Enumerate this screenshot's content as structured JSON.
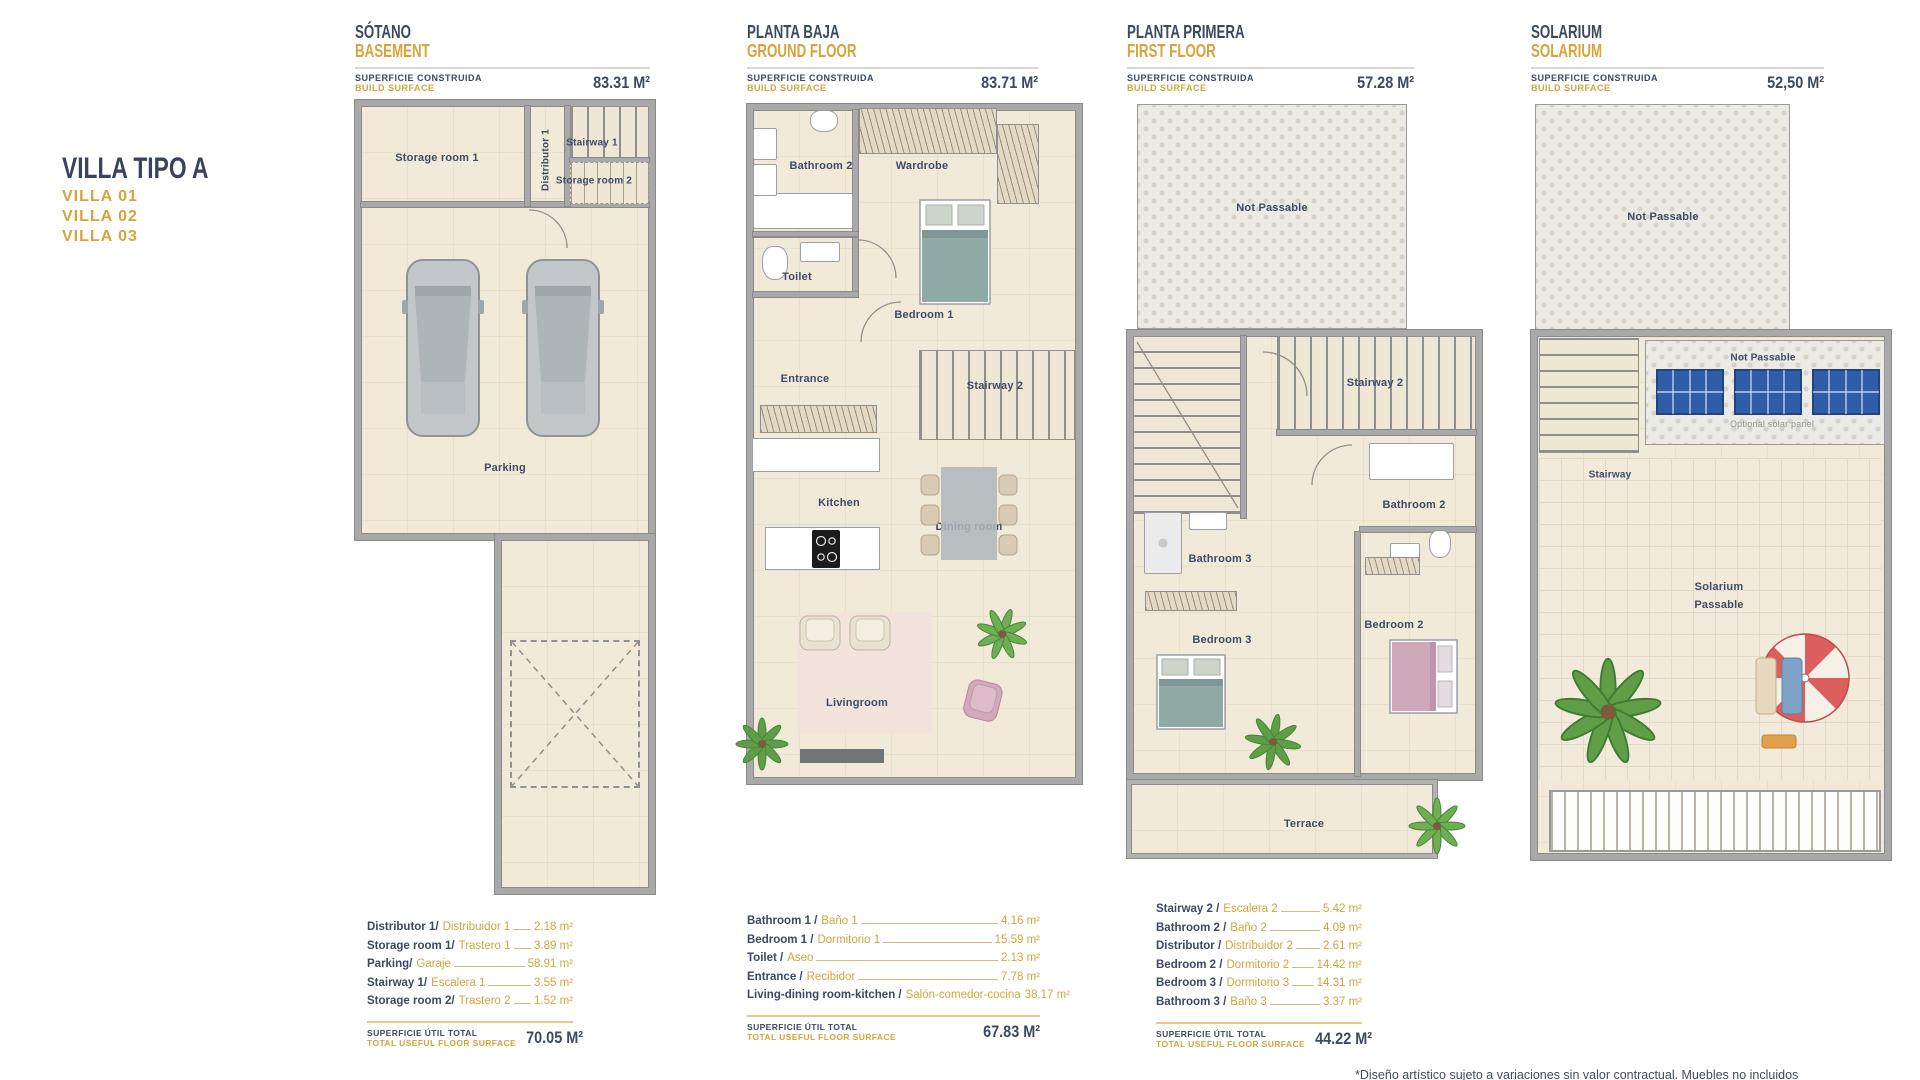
{
  "header": {
    "title": "VILLA TIPO A",
    "villas": [
      "VILLA 01",
      "VILLA 02",
      "VILLA 03"
    ]
  },
  "common": {
    "surface_label_es": "SUPERFICIE CONSTRUIDA",
    "surface_label_en": "BUILD SURFACE",
    "total_label_es": "SUPERFICIE ÚTIL TOTAL",
    "total_label_en": "TOTAL USEFUL FLOOR SURFACE"
  },
  "palette": {
    "navy": "#3C4961",
    "gold": "#D5A43C"
  },
  "plans": [
    {
      "name_es": "SÓTANO",
      "name_en": "BASEMENT",
      "build_surface": "83.31 M²",
      "rooms": {
        "storage1": "Storage room 1",
        "distributor": "Distributor 1",
        "stairway1": "Stairway 1",
        "storage2": "Storage room 2",
        "parking": "Parking"
      },
      "items": [
        {
          "en": "Distributor 1/",
          "es": "Distribuidor 1",
          "value": "2.18 m²"
        },
        {
          "en": "Storage room 1/",
          "es": "Trastero 1",
          "value": "3.89 m²"
        },
        {
          "en": "Parking/",
          "es": "Garaje",
          "value": "58.91 m²"
        },
        {
          "en": "Stairway 1/",
          "es": "Escalera 1",
          "value": "3.55 m²"
        },
        {
          "en": "Storage room 2/",
          "es": "Trastero 2",
          "value": "1.52 m²"
        }
      ],
      "total": "70.05 M²"
    },
    {
      "name_es": "PLANTA BAJA",
      "name_en": "GROUND FLOOR",
      "build_surface": "83.71 M²",
      "rooms": {
        "bathroom2": "Bathroom 2",
        "wardrobe": "Wardrobe",
        "toilet": "Toilet",
        "bedroom1": "Bedroom 1",
        "entrance": "Entrance",
        "stairway2": "Stairway 2",
        "kitchen": "Kitchen",
        "dining": "Dining room",
        "living": "Livingroom"
      },
      "items": [
        {
          "en": "Bathroom 1 /",
          "es": "Baño 1",
          "value": "4.16 m²"
        },
        {
          "en": "Bedroom 1 /",
          "es": "Dormitorio 1",
          "value": "15.59 m²"
        },
        {
          "en": "Toilet /",
          "es": "Aseo",
          "value": "2.13 m²"
        },
        {
          "en": "Entrance /",
          "es": "Recibidor",
          "value": "7.78 m²"
        },
        {
          "en": "Living-dining room-kitchen /",
          "es": "Salón-comedor-cocina",
          "value": "38.17 m²"
        }
      ],
      "total": "67.83 M²"
    },
    {
      "name_es": "PLANTA PRIMERA",
      "name_en": "FIRST FLOOR",
      "build_surface": "57.28 M²",
      "rooms": {
        "not_passable": "Not Passable",
        "stairway2": "Stairway 2",
        "bathroom2": "Bathroom 2",
        "bathroom3": "Bathroom 3",
        "bedroom3": "Bedroom 3",
        "bedroom2": "Bedroom 2",
        "terrace": "Terrace"
      },
      "items": [
        {
          "en": "Stairway 2 /",
          "es": "Escalera 2",
          "value": "5.42 m²"
        },
        {
          "en": "Bathroom 2 /",
          "es": "Baño 2",
          "value": "4.09 m²"
        },
        {
          "en": "Distributor /",
          "es": "Distribuidor 2",
          "value": "2.61 m²"
        },
        {
          "en": "Bedroom 2 /",
          "es": "Dormitorio 2",
          "value": "14.42 m²"
        },
        {
          "en": "Bedroom 3 /",
          "es": "Dormitorio 3",
          "value": "14.31 m²"
        },
        {
          "en": "Bathroom 3 /",
          "es": "Baño 3",
          "value": "3.37 m²"
        }
      ],
      "total": "44.22 M²"
    },
    {
      "name_es": "SOLARIUM",
      "name_en": "SOLARIUM",
      "build_surface": "52,50 M²",
      "rooms": {
        "not_passable_top": "Not Passable",
        "not_passable_panels": "Not Passable",
        "optional_panel": "Optional solar panel",
        "stairway": "Stairway",
        "solarium_line1": "Solarium",
        "solarium_line2": "Passable"
      }
    }
  ],
  "footer": {
    "disclaimer": "*Diseño artístico sujeto a variaciones sin valor contractual. Muebles no incluidos"
  }
}
